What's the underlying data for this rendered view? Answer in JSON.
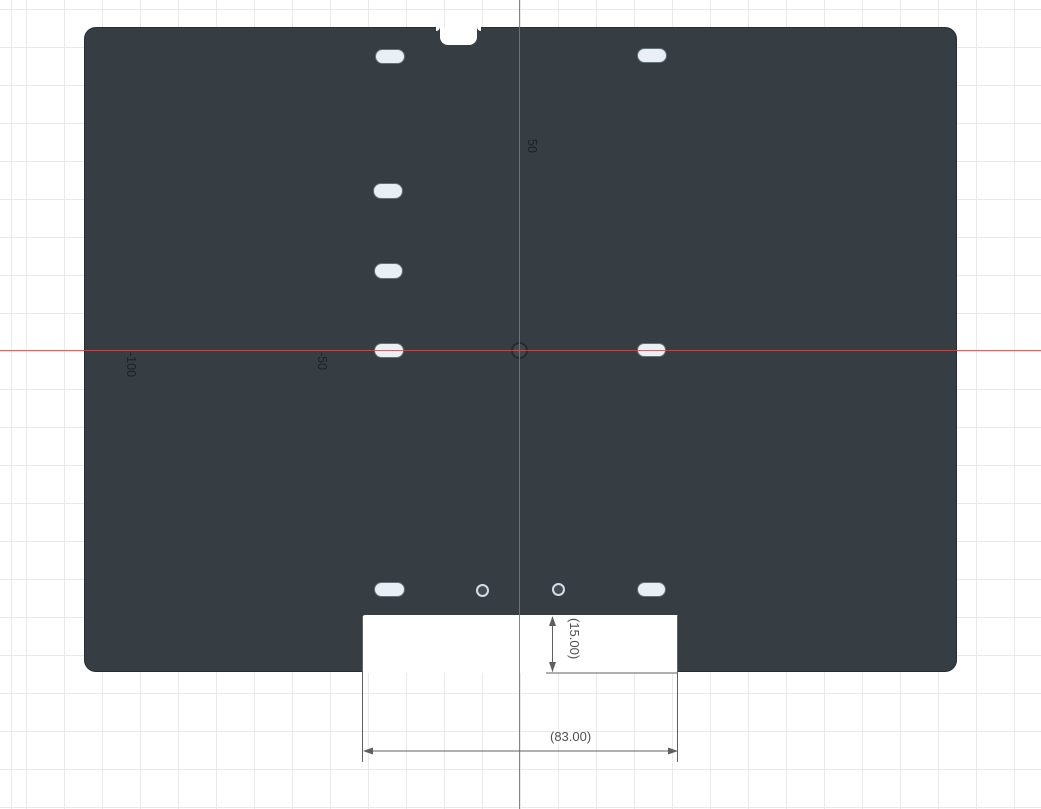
{
  "app": {
    "name": "CAD sketch viewport"
  },
  "canvas": {
    "background_color": "#ffffff",
    "grid_color": "#e9e9ec",
    "grid_spacing_px": 38,
    "axis_x_color": "#c65050",
    "axis_y_color": "#3aa23a",
    "origin_px": {
      "x": 520,
      "y": 350.5
    }
  },
  "axis_labels": [
    {
      "text": "50",
      "axis": "y"
    },
    {
      "text": "-50",
      "axis": "x"
    },
    {
      "text": "-100",
      "axis": "x"
    }
  ],
  "part": {
    "name": "plate",
    "color": "#363e43",
    "slot_color": "#e9f0f5",
    "slots": [
      {
        "x": 376,
        "y": 50,
        "w": 28,
        "h": 13
      },
      {
        "x": 638,
        "y": 49,
        "w": 28,
        "h": 13
      },
      {
        "x": 374,
        "y": 184,
        "w": 28,
        "h": 14
      },
      {
        "x": 375,
        "y": 264,
        "w": 27,
        "h": 14
      },
      {
        "x": 375,
        "y": 344,
        "w": 28,
        "h": 13
      },
      {
        "x": 638,
        "y": 344,
        "w": 27,
        "h": 12
      },
      {
        "x": 375,
        "y": 583,
        "w": 29,
        "h": 13
      },
      {
        "x": 638,
        "y": 583,
        "w": 27,
        "h": 13
      }
    ],
    "holes": [
      {
        "cx": 482.5,
        "cy": 590,
        "d": 13
      },
      {
        "cx": 558.5,
        "cy": 589.5,
        "d": 13
      }
    ],
    "top_notch": {
      "label": "top edge notch"
    },
    "bottom_notch": {
      "label": "bottom edge cutout"
    }
  },
  "dimensions": [
    {
      "label": "(15.00)",
      "orientation": "vertical",
      "reference": true
    },
    {
      "label": "(83.00)",
      "orientation": "horizontal",
      "reference": true
    }
  ],
  "dimension_color": "#606060"
}
